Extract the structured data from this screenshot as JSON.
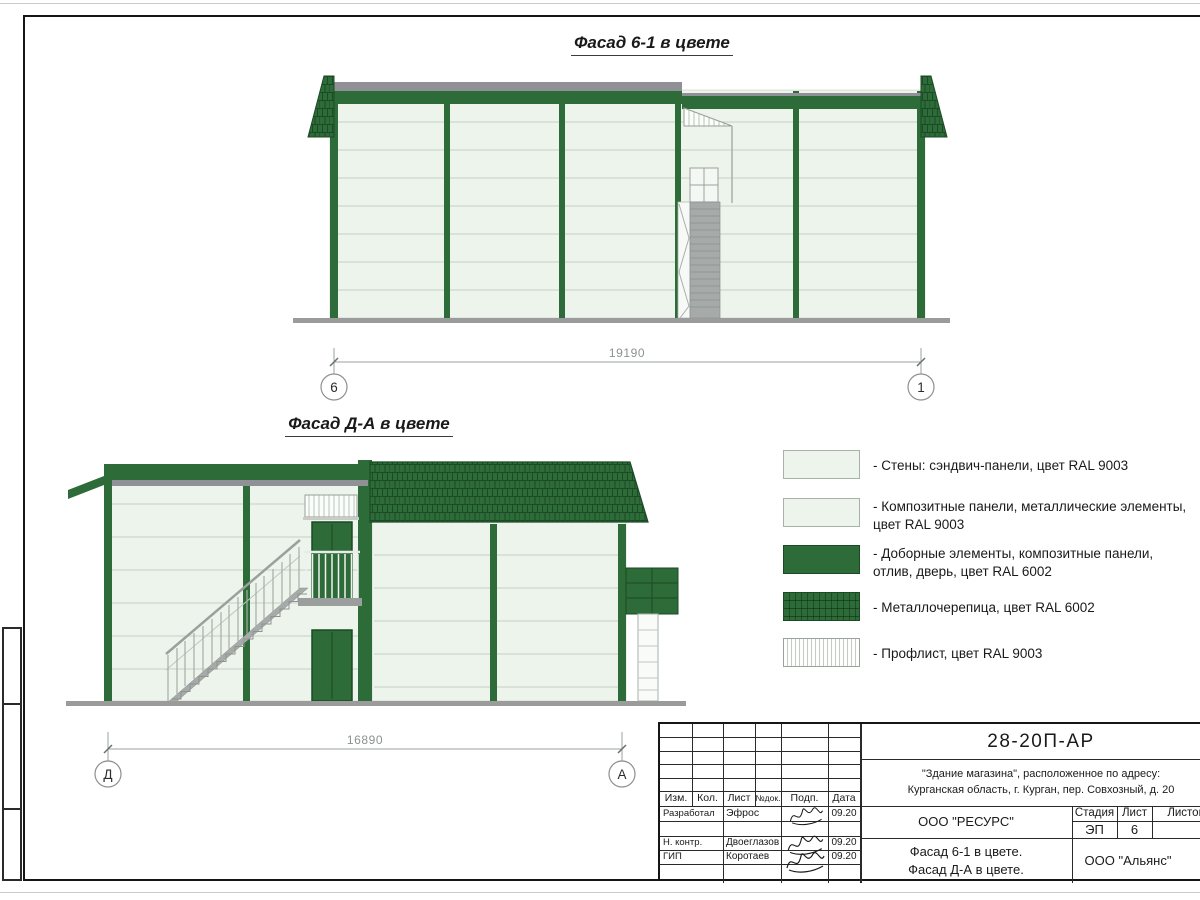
{
  "colors": {
    "green": "#2d6b38",
    "green_dark": "#1d4a26",
    "panel": "#edf4ec",
    "panel_line": "#c3cfc3",
    "ridge_gray": "#8f9196",
    "stair_gray": "#a6aaa8",
    "ground_gray": "#9b9b9b",
    "ink": "#161616"
  },
  "facade1": {
    "title": "Фасад 6-1 в цвете",
    "dimension": "19190",
    "axis_left": "6",
    "axis_right": "1"
  },
  "facade2": {
    "title": "Фасад Д-А в цвете",
    "dimension": "16890",
    "axis_left": "Д",
    "axis_right": "А"
  },
  "legend": {
    "items": [
      {
        "material": "sandwich-panel",
        "label": "- Стены: сэндвич-панели, цвет RAL 9003"
      },
      {
        "material": "composite-panel",
        "label": "- Композитные панели, металлические элементы, цвет RAL 9003"
      },
      {
        "material": "trim-elements",
        "label": "- Доборные элементы,  композитные панели, отлив, дверь, цвет RAL 6002"
      },
      {
        "material": "metal-tile",
        "label": "- Металлочерепица, цвет RAL 6002"
      },
      {
        "material": "profiled-sheet",
        "label": "- Профлист, цвет RAL 9003"
      }
    ]
  },
  "title_block": {
    "doc_number": "28-20П-АР",
    "project_line1": "\"Здание магазина\", расположенное по адресу:",
    "project_line2": "Курганская область, г. Курган, пер. Совхозный, д. 20",
    "header": {
      "izm": "Изм.",
      "kol": "Кол.",
      "list": "Лист",
      "ndok": "№док.",
      "podp": "Подп.",
      "data": "Дата"
    },
    "rows": [
      {
        "role": "Разработал",
        "name": "Эфрос",
        "date": "09.20"
      },
      {
        "role": "Н. контр.",
        "name": "Двоеглазов",
        "date": "09.20"
      },
      {
        "role": "ГИП",
        "name": "Коротаев",
        "date": "09.20"
      }
    ],
    "org": "ООО \"РЕСУРС\"",
    "sheet_title_line1": "Фасад 6-1 в цвете.",
    "sheet_title_line2": "Фасад Д-А в цвете.",
    "stage_label": "Стадия",
    "sheet_label": "Лист",
    "sheets_label": "Листов",
    "stage_value": "ЭП",
    "sheet_value": "6",
    "contractor": "ООО \"Альянс\""
  }
}
